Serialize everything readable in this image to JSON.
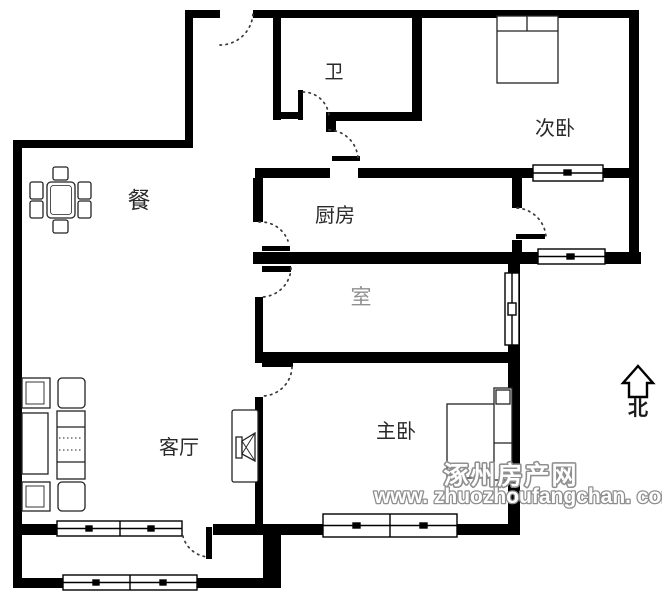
{
  "floorplan": {
    "rooms": [
      {
        "id": "bathroom",
        "label": "卫"
      },
      {
        "id": "secondary-bedroom",
        "label": "次卧"
      },
      {
        "id": "dining-area",
        "label": "餐"
      },
      {
        "id": "kitchen",
        "label": "厨房"
      },
      {
        "id": "middle-room",
        "label": "室"
      },
      {
        "id": "living-room",
        "label": "客厅"
      },
      {
        "id": "master-bedroom",
        "label": "主卧"
      }
    ],
    "compass": {
      "label": "北",
      "direction": "north"
    },
    "watermark": {
      "site_name": "涿州房产网",
      "site_url": "www. zhuozhoufangchan. com"
    },
    "colors": {
      "wall": "#000000",
      "background": "#ffffff",
      "furniture_stroke": "#222222",
      "door_arc": "#3a3a3a",
      "label": "#2a2a2a",
      "faded_label": "#8f8f8f",
      "watermark_fill": "#ffffff",
      "watermark_stroke": "#8f8f8f"
    }
  }
}
